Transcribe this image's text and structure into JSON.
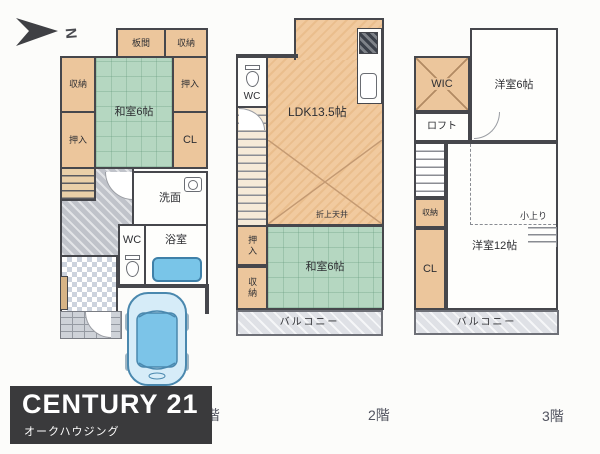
{
  "compass": {
    "label": "N"
  },
  "floor1": {
    "floor_label": "1階",
    "rooms": {
      "itanoma": "板間",
      "storage_top": "収納",
      "storage_left": "収納",
      "washitsu": "和室6帖",
      "oshiire_right": "押入",
      "oshiire_left": "押入",
      "closet": "CL",
      "washroom": "洗面",
      "wc": "WC",
      "bathroom": "浴室"
    }
  },
  "floor2": {
    "floor_label": "2階",
    "rooms": {
      "wc": "WC",
      "ldk": "LDK13.5帖",
      "ceiling_note": "折上天井",
      "oshiire": "押入",
      "storage": "収納",
      "washitsu": "和室6帖",
      "balcony": "バルコニー"
    }
  },
  "floor3": {
    "floor_label": "3階",
    "rooms": {
      "wic": "WIC",
      "western6": "洋室6帖",
      "loft": "ロフト",
      "storage": "収納",
      "closet": "CL",
      "western12": "洋室12帖",
      "koagari": "小上り",
      "balcony": "バルコニー"
    }
  },
  "logo": {
    "brand": "CENTURY 21",
    "company": "オークハウジング"
  },
  "colors": {
    "tatami_green": "#b5d7c1",
    "room_peach": "#ecc69c",
    "ldk_peach": "#f1ca9f",
    "hall_gray": "#c0c3ca",
    "water_blue": "#79c5e8",
    "wall_dark": "#46474c",
    "logo_bg": "#3a3a3c"
  }
}
